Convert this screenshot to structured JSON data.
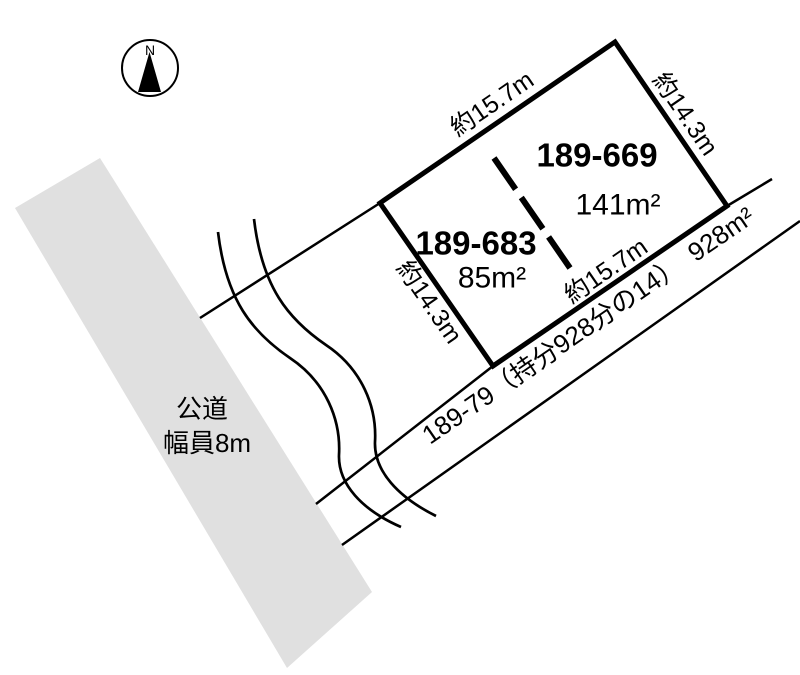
{
  "compass": {
    "north_label": "N"
  },
  "public_road": {
    "name": "公道",
    "width_label": "幅員8m"
  },
  "private_road": {
    "label": "189-79（持分928分の14）　928m²"
  },
  "parcels": [
    {
      "id": "189-669",
      "area": "141m²"
    },
    {
      "id": "189-683",
      "area": "85m²"
    }
  ],
  "dimension_labels": {
    "top": "約15.7m",
    "right": "約14.3m",
    "left": "約14.3m",
    "bottom": "約15.7m"
  },
  "colors": {
    "road_fill": "#e0e0e0",
    "ink": "#000000"
  }
}
